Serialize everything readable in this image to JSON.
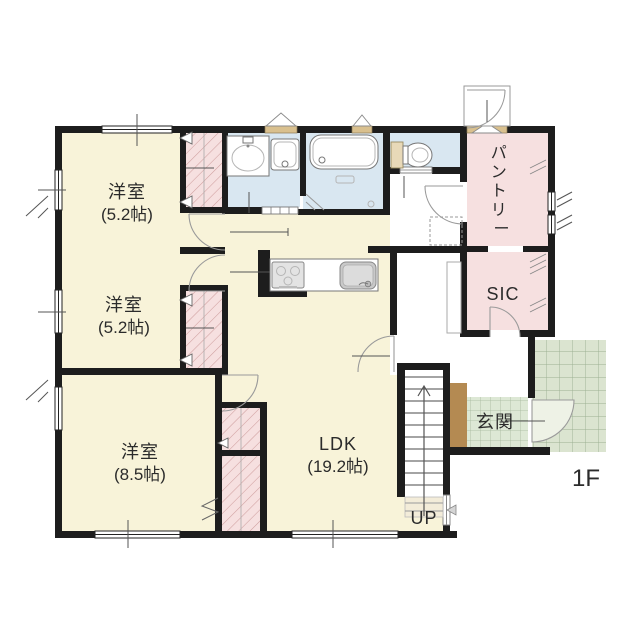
{
  "meta": {
    "floor_label": "1F"
  },
  "rooms": {
    "bedroom1": {
      "name": "洋室",
      "size": "(5.2帖)"
    },
    "bedroom2": {
      "name": "洋室",
      "size": "(5.2帖)"
    },
    "bedroom3": {
      "name": "洋室",
      "size": "(8.5帖)"
    },
    "ldk": {
      "name": "LDK",
      "size": "(19.2帖)"
    },
    "pantry": {
      "label": "パントリー",
      "chars": [
        "パ",
        "ン",
        "ト",
        "リ",
        "ー"
      ]
    },
    "sic": {
      "label": "SIC"
    },
    "entrance": {
      "label": "玄関"
    },
    "stairs": {
      "direction_label": "UP"
    }
  },
  "colors": {
    "wall": "#1d1d1d",
    "floor_cream": "#f8f3d9",
    "wet_blue": "#d9e7f1",
    "closet_pink": "#f6e0e0",
    "tile_green": "#dde8d5",
    "porch_green": "#dbe4d0",
    "wood": "#b48a52",
    "frame_tan": "#d9c08e"
  }
}
